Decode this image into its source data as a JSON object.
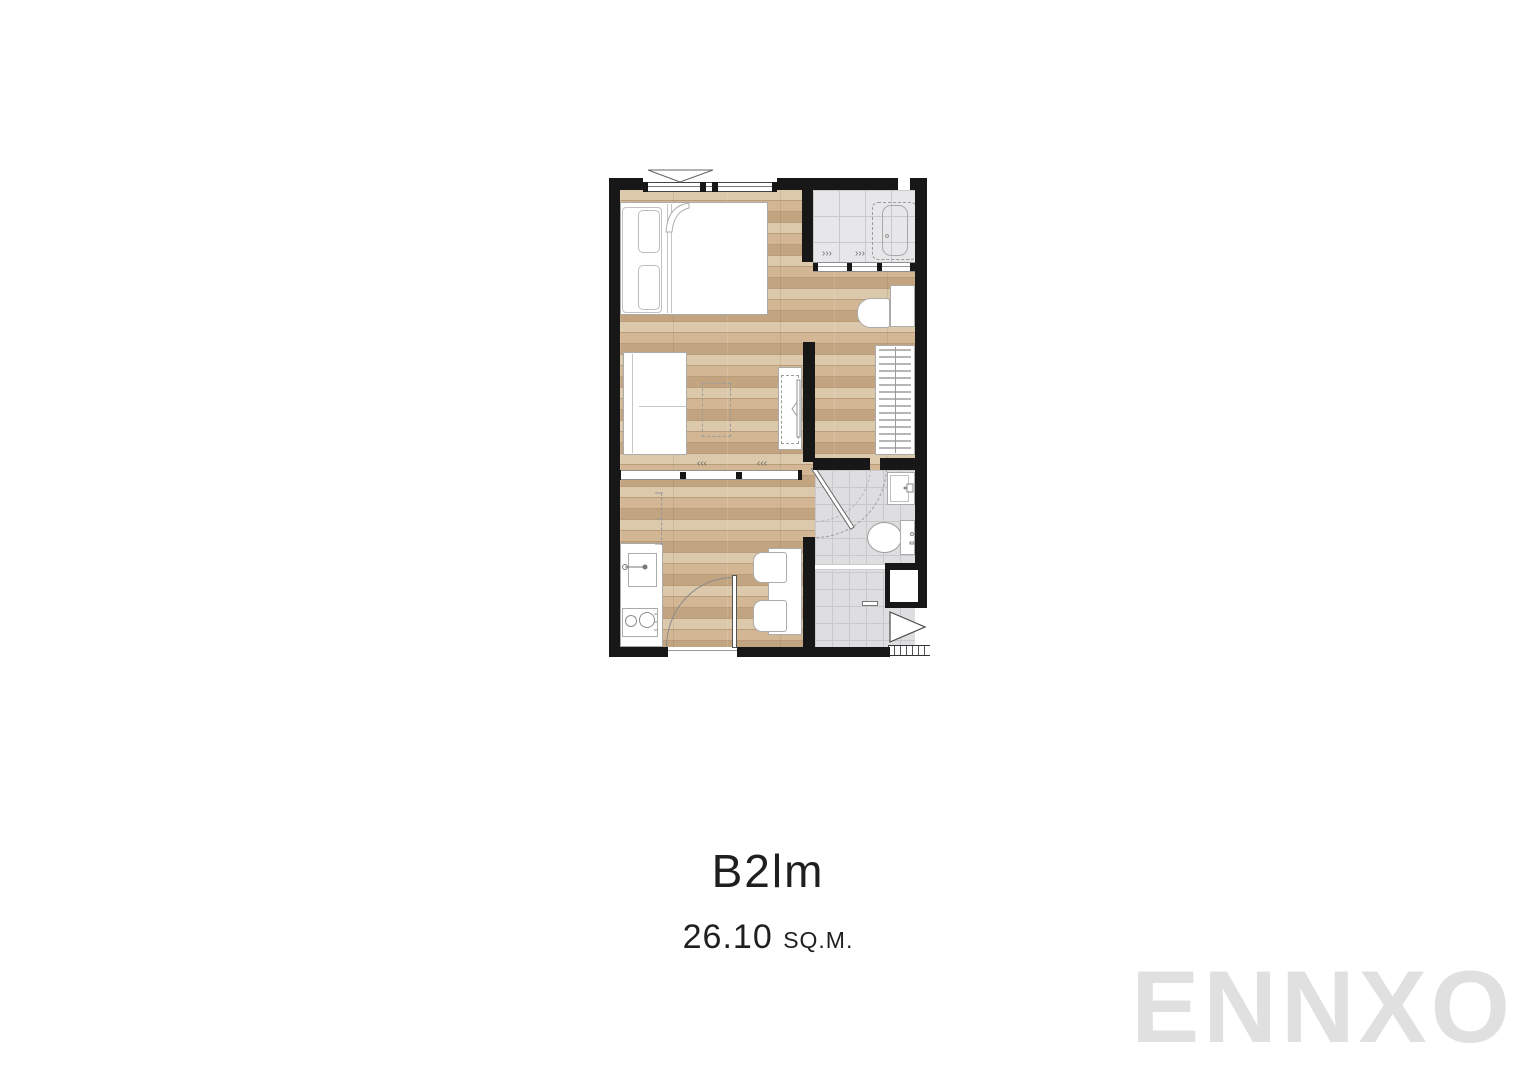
{
  "page": {
    "background": "#ffffff"
  },
  "unit": {
    "name": "B2lm",
    "area": "26.10",
    "area_unit": "SQ.M."
  },
  "watermark": {
    "text": "ENNXO"
  },
  "colors": {
    "wall": "#171717",
    "wood_base": "#d3b794",
    "wood_light": "#dcc8aa",
    "wood_dark": "#c2a480",
    "wood_seam": "#b99c79",
    "tile_balcony": "#e7e7e9",
    "tile_bath": "#dedee1",
    "tile_line": "#c9c9cd",
    "outline": "#ababab",
    "text": "#1f1f1f",
    "watermark_color": "#e0e0e0"
  },
  "plan": {
    "marks": {
      "slide_left": "‹‹‹",
      "slide_right": "›››"
    },
    "rooms": [
      "bedroom",
      "living-dining",
      "kitchen",
      "balcony",
      "bathroom",
      "dressing-corridor"
    ],
    "furniture": [
      "double-bed",
      "sofa",
      "tv-console",
      "media-rug",
      "wardrobe",
      "desk",
      "desk-chair",
      "dining-table",
      "dining-chair",
      "kitchen-counter",
      "kitchen-sink",
      "stove",
      "air-conditioner-unit",
      "wash-basin",
      "toilet",
      "shower-area",
      "entry-door",
      "bathroom-door",
      "sliding-partition",
      "balcony-sliding-door",
      "window"
    ]
  }
}
